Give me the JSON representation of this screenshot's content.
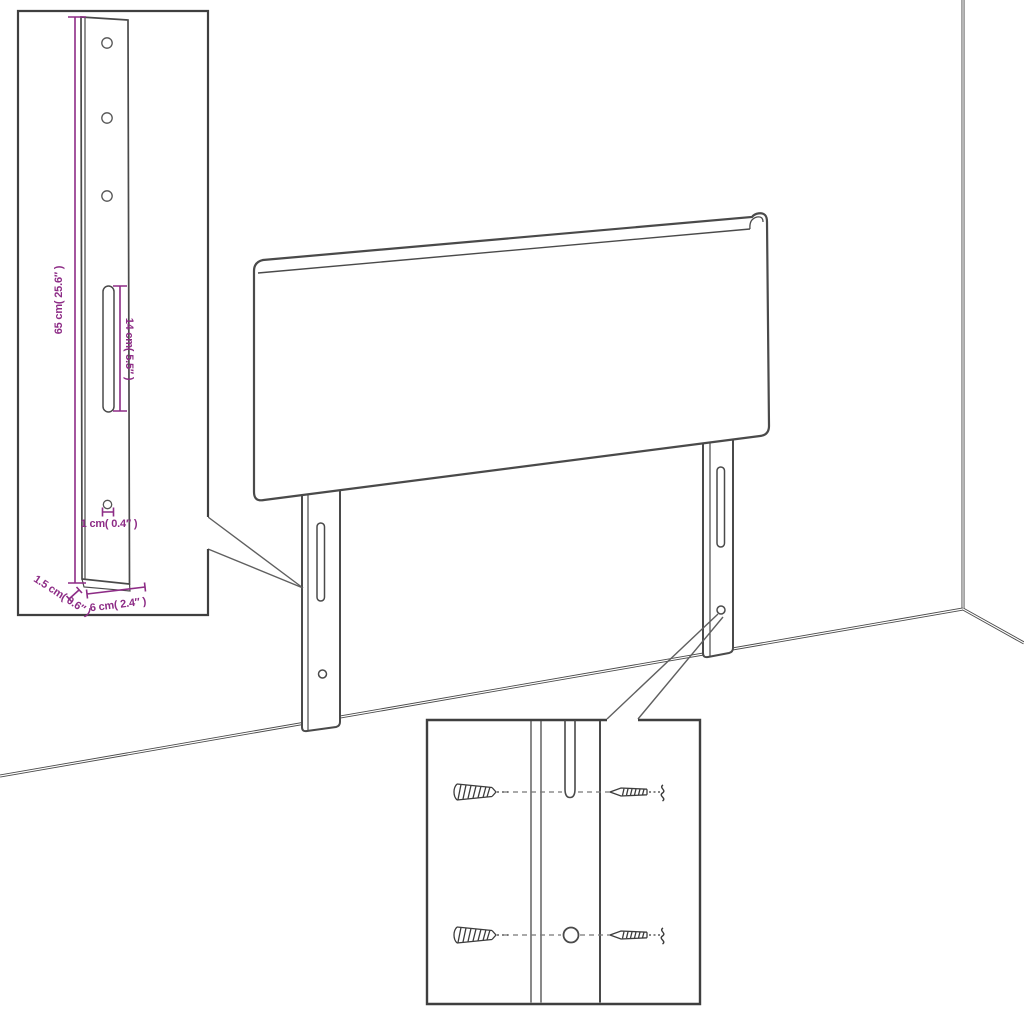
{
  "dimension_labels": {
    "bracket_height": "65 cm( 25.6″ )",
    "slot_length": "14 cm( 5.5″ )",
    "hole_diameter": "1 cm( 0.4″ )",
    "bracket_thickness": "1.5 cm( 0.6″ )",
    "bracket_width": "6 cm( 2.4″ )"
  },
  "icons": [
    "wall-plug-icon",
    "screw-icon",
    "wall-break-squiggle-icon"
  ],
  "colors": {
    "background": "#ffffff",
    "line_art": "#4a4a4a",
    "inset_border": "#3f3f3f",
    "dimension_accent": "#8d2c86"
  }
}
